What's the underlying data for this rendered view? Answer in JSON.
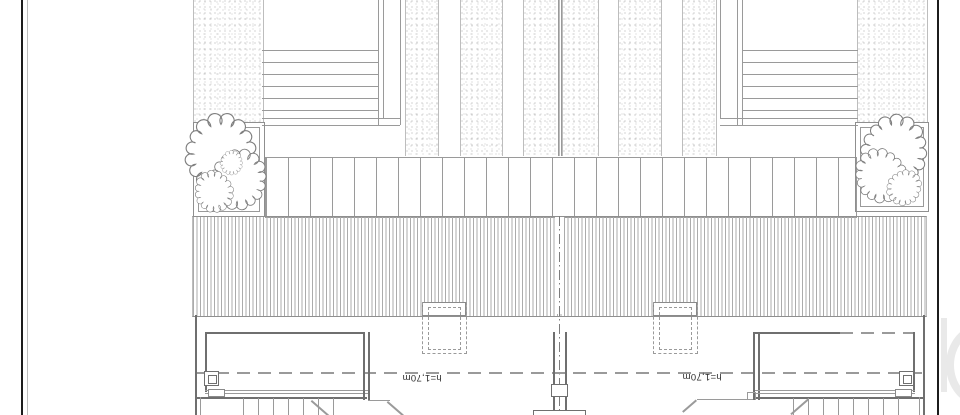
{
  "drawing": {
    "type": "architectural-plan-scan",
    "labels": {
      "height_left": "h=1,70m",
      "height_right": "h=1,70m"
    }
  },
  "colors": {
    "paper": "#ffffff",
    "line": "#9a9a9a",
    "line_dark": "#6f6f6f",
    "line_light": "#bdbdbd",
    "sheet_edge": "#1c1c1c",
    "text": "#2f2f2f",
    "watermark": "#e9e9e9"
  }
}
